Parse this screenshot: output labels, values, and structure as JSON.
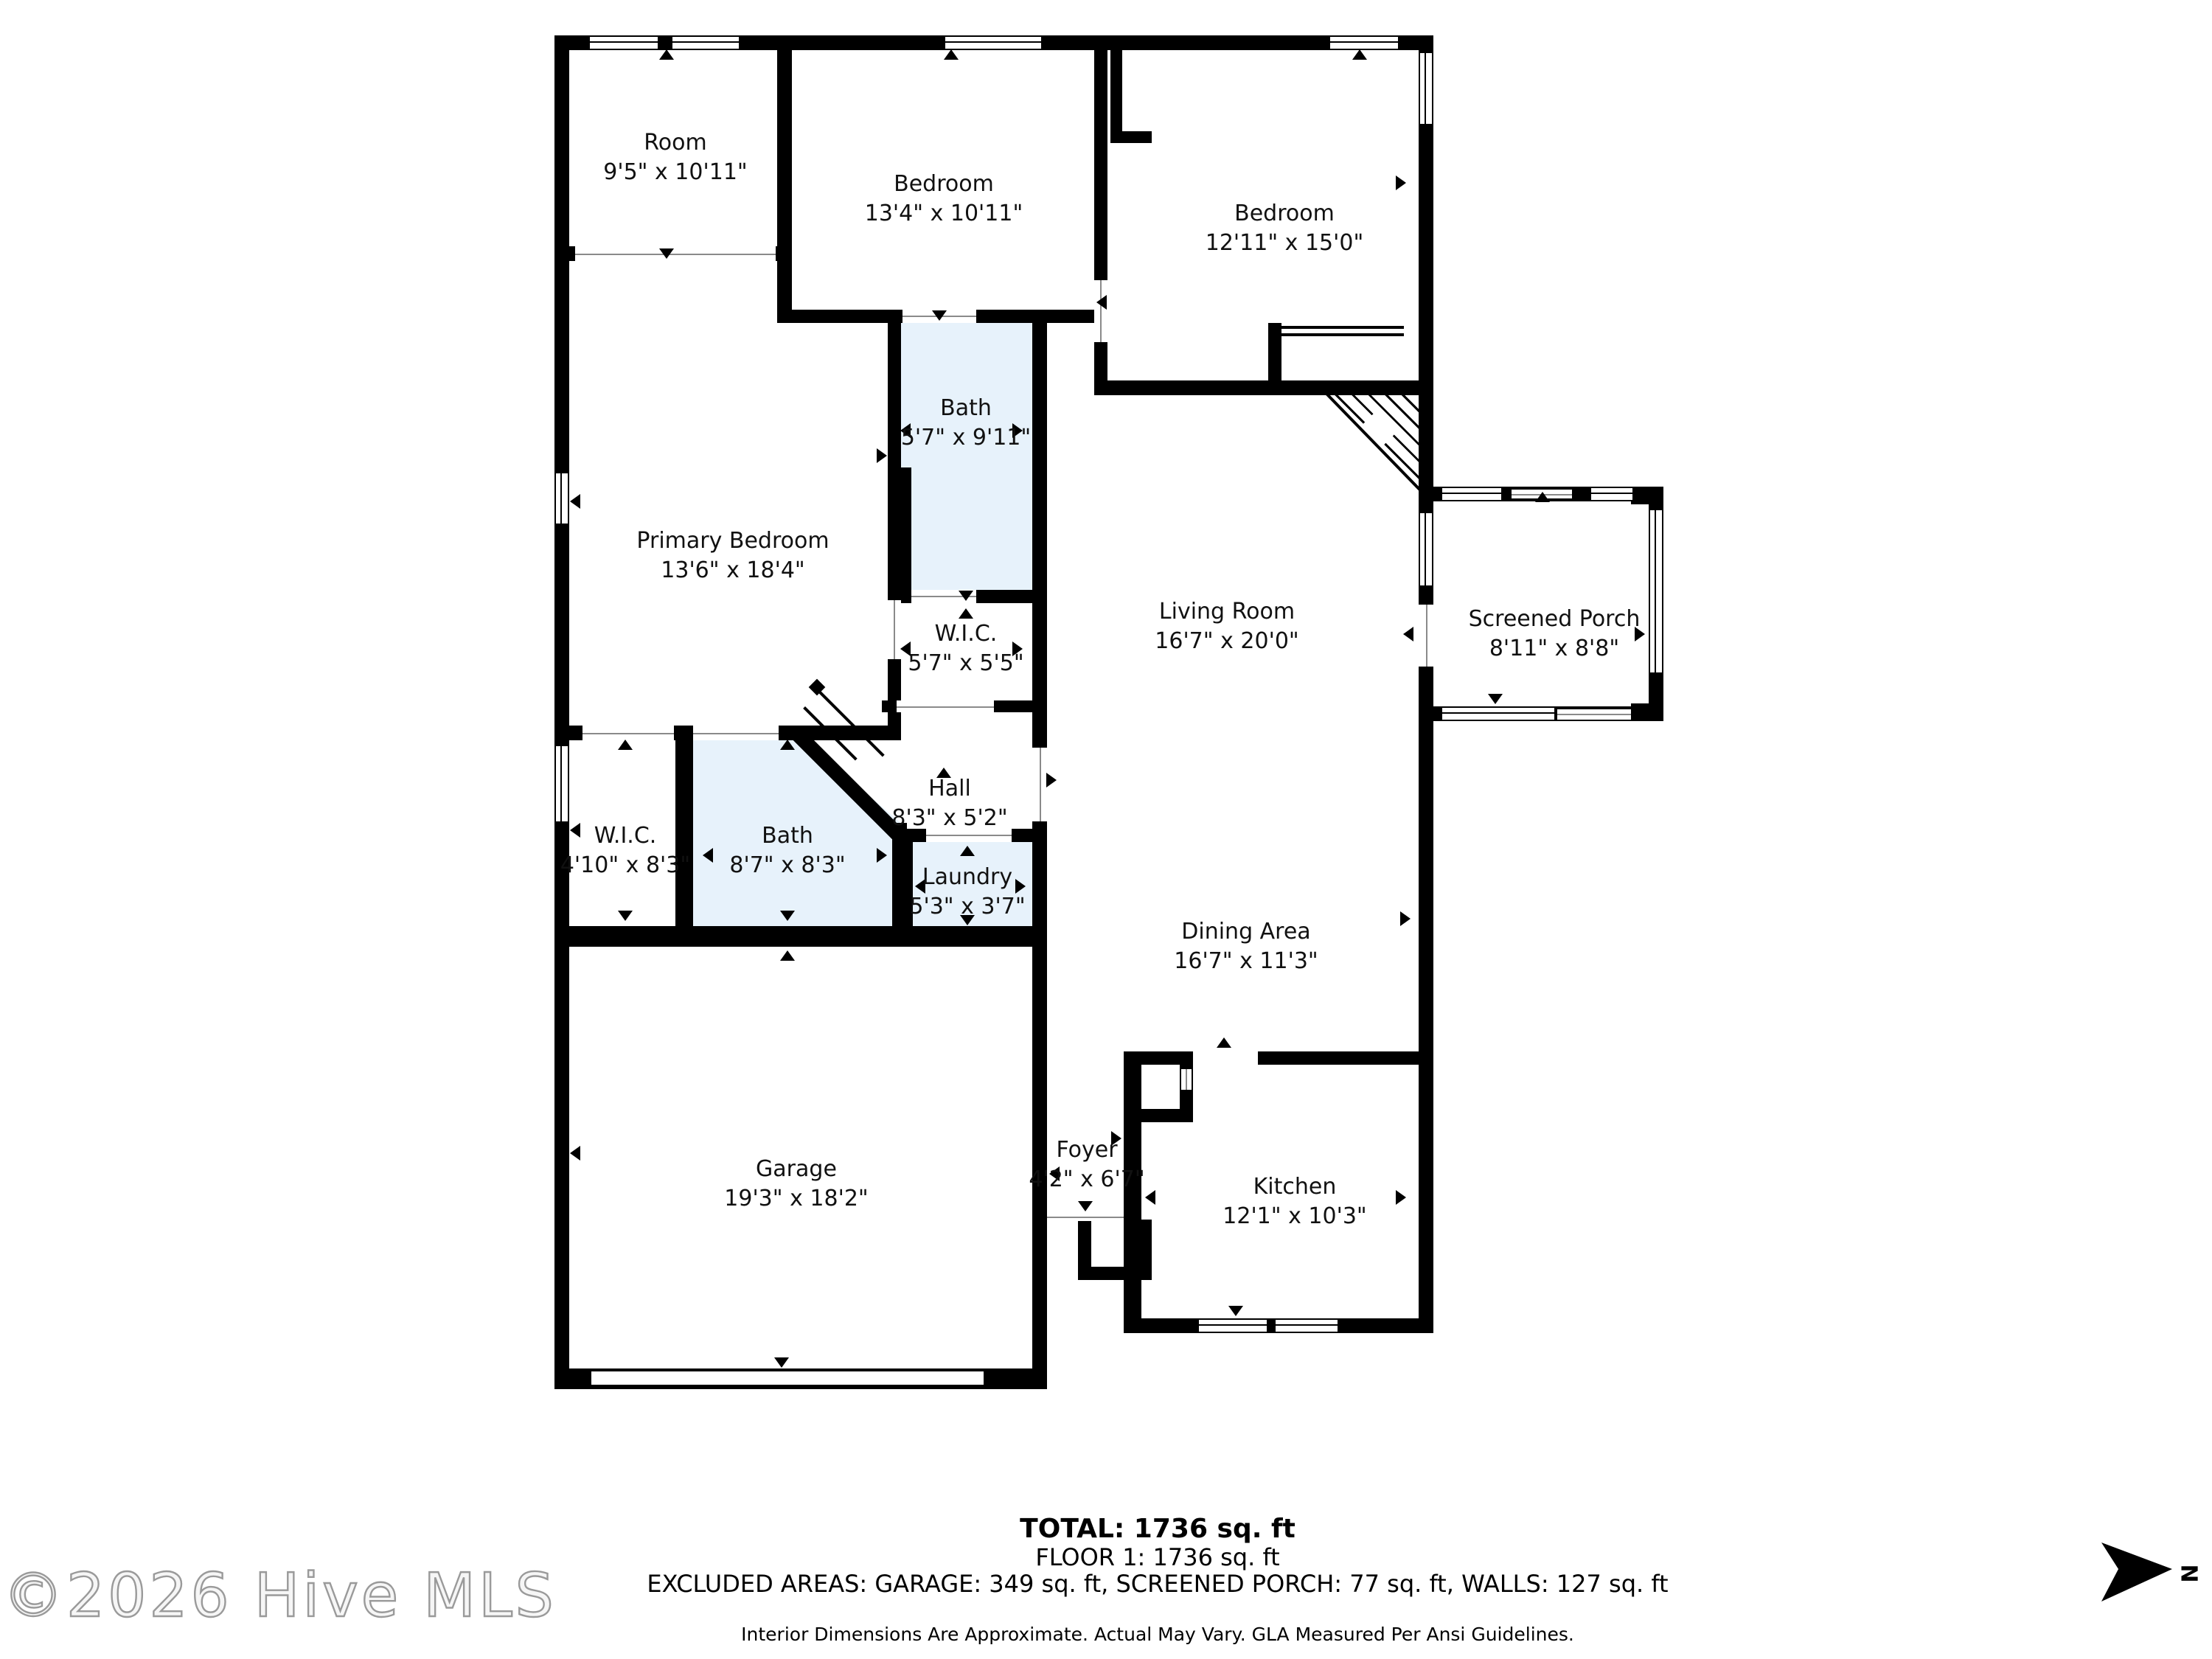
{
  "rooms": {
    "room": {
      "name": "Room",
      "dims": "9'5\" x 10'11\""
    },
    "bedroom2": {
      "name": "Bedroom",
      "dims": "13'4\" x 10'11\""
    },
    "bedroom3": {
      "name": "Bedroom",
      "dims": "12'11\" x 15'0\""
    },
    "bath1": {
      "name": "Bath",
      "dims": "5'7\" x 9'11\""
    },
    "primary": {
      "name": "Primary Bedroom",
      "dims": "13'6\" x 18'4\""
    },
    "wic1": {
      "name": "W.I.C.",
      "dims": "5'7\" x 5'5\""
    },
    "living": {
      "name": "Living Room",
      "dims": "16'7\" x 20'0\""
    },
    "porch": {
      "name": "Screened Porch",
      "dims": "8'11\" x 8'8\""
    },
    "hall": {
      "name": "Hall",
      "dims": "8'3\" x 5'2\""
    },
    "wic2": {
      "name": "W.I.C.",
      "dims": "4'10\" x 8'3\""
    },
    "bath2": {
      "name": "Bath",
      "dims": "8'7\" x 8'3\""
    },
    "laundry": {
      "name": "Laundry",
      "dims": "5'3\" x 3'7\""
    },
    "dining": {
      "name": "Dining Area",
      "dims": "16'7\" x 11'3\""
    },
    "garage": {
      "name": "Garage",
      "dims": "19'3\" x 18'2\""
    },
    "foyer": {
      "name": "Foyer",
      "dims": "4'2\" x 6'7\""
    },
    "kitchen": {
      "name": "Kitchen",
      "dims": "12'1\" x 10'3\""
    }
  },
  "summary": {
    "total": "TOTAL: 1736  sq. ft",
    "floor": "FLOOR 1: 1736  sq. ft",
    "excluded": "EXCLUDED AREAS: GARAGE: 349 sq. ft, SCREENED PORCH: 77 sq. ft, WALLS: 127 sq. ft",
    "disclaimer": "Interior Dimensions Are Approximate. Actual May Vary. GLA Measured Per Ansi Guidelines."
  },
  "watermark": "©2026 Hive MLS",
  "compass": {
    "label": "N"
  },
  "icons": {
    "north_arrow": "right-pointing-dart",
    "markers": "small-triangle-door-window-markers"
  },
  "colors": {
    "wall": "#000000",
    "wet_room_fill": "#e7f2fb",
    "background": "#ffffff",
    "watermark_outline": "#9a9a9a"
  }
}
